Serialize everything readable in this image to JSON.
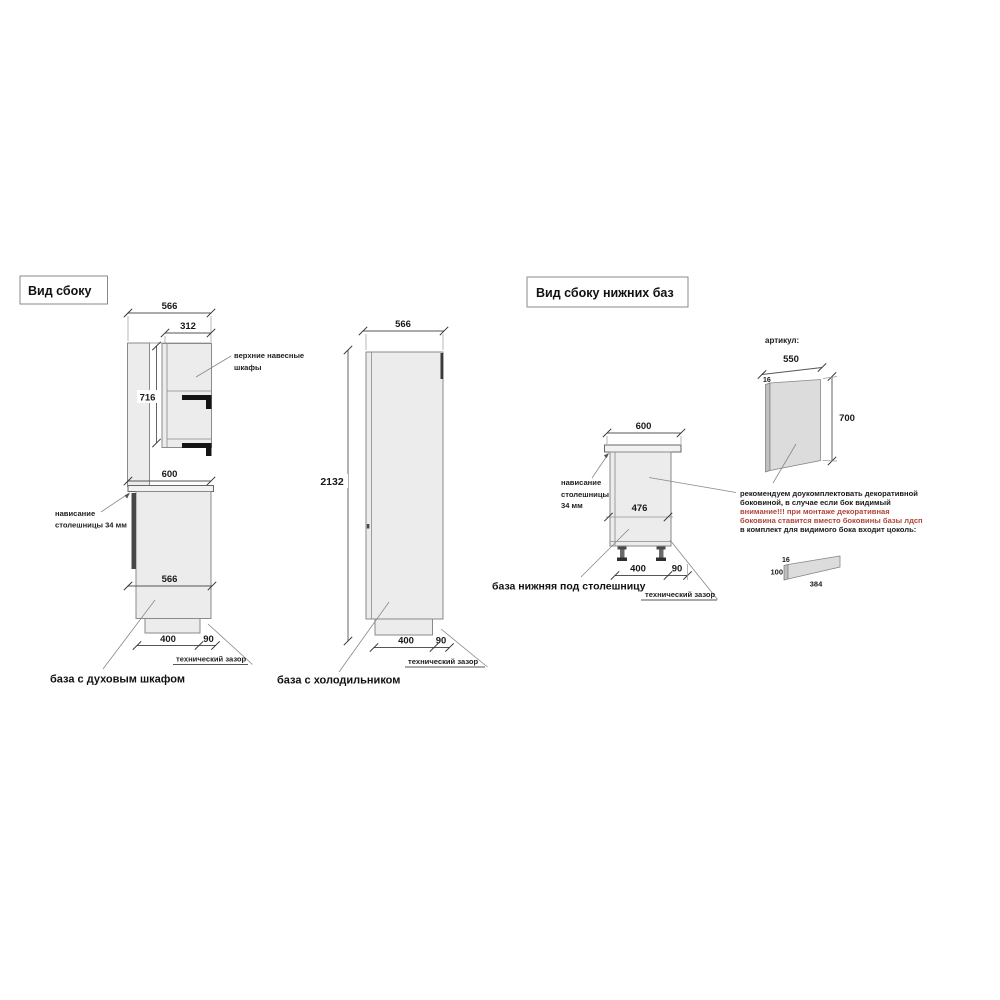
{
  "titles": {
    "side_view": "Вид сбоку",
    "side_view_lower": "Вид сбоку  нижних баз"
  },
  "oven_base": {
    "caption": "база с духовым шкафом",
    "label_upper_1": "верхние навесные",
    "label_upper_2": "шкафы",
    "label_overhang_1": "нависание",
    "label_overhang_2": "столешницы 34 мм",
    "label_tech_gap": "технический зазор",
    "dims": {
      "total_depth": "566",
      "upper_depth": "312",
      "upper_height": "716",
      "counter_depth": "600",
      "base_depth": "566",
      "plinth_depth": "400",
      "gap": "90"
    }
  },
  "fridge_base": {
    "caption": "база с холодильником",
    "label_tech_gap": "технический зазор",
    "dims": {
      "depth": "566",
      "height": "2132",
      "plinth_depth": "400",
      "gap": "90"
    }
  },
  "lower_base": {
    "caption": "база нижняя под столешницу",
    "label_overhang_1": "нависание",
    "label_overhang_2": "столешницы",
    "label_overhang_3": "34 мм",
    "label_tech_gap": "технический зазор",
    "dims": {
      "counter_depth": "600",
      "body_depth": "476",
      "plinth_depth": "400",
      "gap": "90"
    }
  },
  "side_panel": {
    "article_label": "артикул:",
    "dims": {
      "width": "550",
      "thickness": "16",
      "height": "700"
    }
  },
  "plinth_part": {
    "dims": {
      "thickness": "16",
      "height": "100",
      "length": "384"
    }
  },
  "notes": {
    "lines": [
      {
        "text": "рекомендуем доукомплектовать декоративной",
        "color": "#1a1a1a"
      },
      {
        "text": "боковиной, в случае если бок видимый",
        "color": "#1a1a1a"
      },
      {
        "text": "внимание!!! при монтаже декоративная",
        "color": "#b0453a"
      },
      {
        "text": "боковина ставится вместо боковины базы лдсп",
        "color": "#b0453a"
      },
      {
        "text": "в комплект для видимого бока входит цоколь:",
        "color": "#1a1a1a"
      }
    ]
  }
}
